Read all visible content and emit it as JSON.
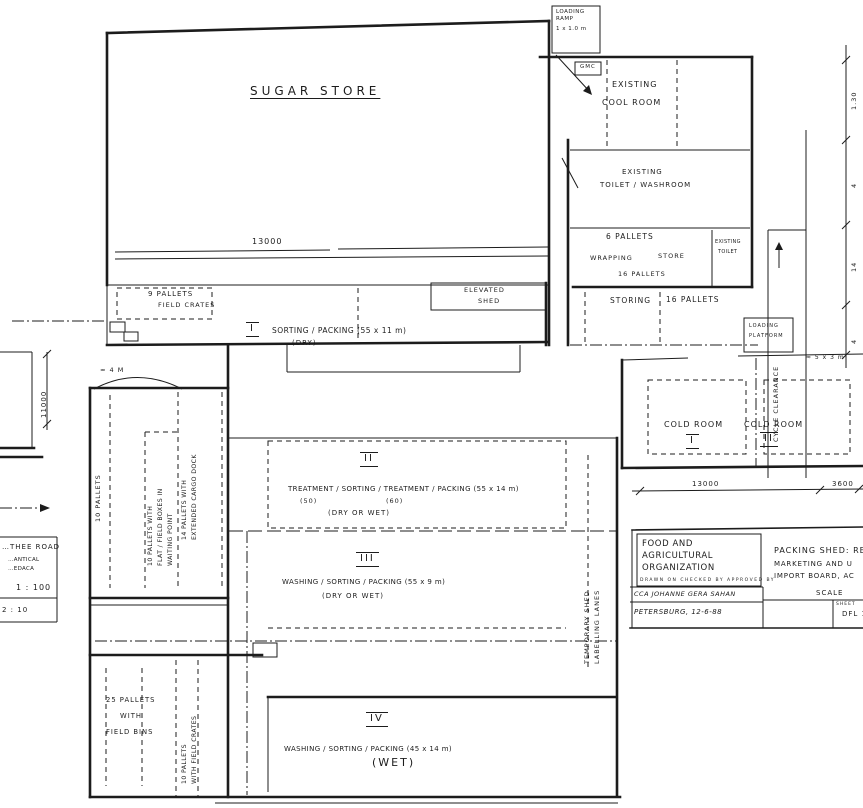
{
  "rooms": {
    "sugar_store": "SUGAR STORE",
    "loading_ramp": [
      "LOADING",
      "RAMP",
      "1 x 1.0 m"
    ],
    "gmc": "GMC",
    "cool_room": [
      "EXISTING",
      "COOL ROOM"
    ],
    "toilet_washroom": [
      "EXISTING",
      "TOILET / WASHROOM"
    ],
    "pallet_store": {
      "p6": "6 PALLETS",
      "wrapping": "WRAPPING",
      "store": "STORE",
      "p16": "16 PALLETS"
    },
    "toilet_small": [
      "EXISTING",
      "TOILET"
    ],
    "storing": {
      "label": "STORING",
      "value": "16 PALLETS"
    },
    "elevated_shed": [
      "ELEVATED",
      "SHED"
    ],
    "cold_room_1": {
      "name": "COLD ROOM",
      "num": "I"
    },
    "cold_room_2": {
      "name": "COLD ROOM",
      "num": "II"
    },
    "cycle_clearance": "CYCLE CLEARANCE",
    "loading_platform": [
      "LOADING",
      "PLATFORM"
    ],
    "temporary_shed": [
      "TEMPORARY SHED",
      "LABELLING LANES"
    ]
  },
  "sections": {
    "s1": {
      "num": "I",
      "text": "SORTING / PACKING   (55 x 11 m)",
      "sub": "(DRY)"
    },
    "s2": {
      "num": "II",
      "text": "TREATMENT / SORTING / TREATMENT / PACKING   (55 x 14 m)",
      "sub1": "(50)",
      "sub2": "(60)",
      "mode": "(DRY OR WET)"
    },
    "s3": {
      "num": "III",
      "text": "WASHING / SORTING / PACKING   (55 x 9 m)",
      "mode": "(DRY OR WET)"
    },
    "s4": {
      "num": "IV",
      "text": "WASHING / SORTING / PACKING   (45 x 14 m)",
      "mode": "(WET)"
    }
  },
  "pallets": {
    "p9": [
      "9 PALLETS",
      "FIELD CRATES"
    ],
    "p10": "10 PALLETS",
    "p10_fruit": [
      "10 PALLETS WITH",
      "FLAT / FIELD BOXES IN",
      "WAITING POINT"
    ],
    "p14": [
      "14 PALLETS WITH",
      "EXTENDED CARGO DOCK"
    ],
    "p25": [
      "25 PALLETS",
      "WITH",
      "FIELD BINS"
    ],
    "p10_crates": [
      "10 PALLETS",
      "WITH FIELD CRATES"
    ]
  },
  "dimensions": {
    "top": "13000",
    "left": "11000",
    "cold_a": "13000",
    "cold_b": "3600",
    "right_chain": [
      "1.30",
      "4",
      "14",
      "4"
    ],
    "note": "≈ 5 x 3 m",
    "arc": "≈ 4 M"
  },
  "title_block": {
    "org": [
      "FOOD AND",
      "AGRICULTURAL",
      "ORGANIZATION"
    ],
    "byline_header": "DRAWN ON      CHECKED BY      APPROVED BY",
    "byline": "CCA JOHANNE GERA SAHAN",
    "date_line": "PETERSBURG, 12-6-88",
    "project": [
      "PACKING SHED: RE",
      "MARKETING AND U",
      "IMPORT BOARD, AC"
    ],
    "scale_label": "SCALE",
    "sheet_label": "SHEET",
    "sheet_value": "DFL 1"
  },
  "left_title_block": {
    "line1": "…THEE ROAD",
    "line2": "…ANTICAL",
    "line3": "…EDACA",
    "scale": "1 : 100",
    "line5": "2 : 10"
  }
}
